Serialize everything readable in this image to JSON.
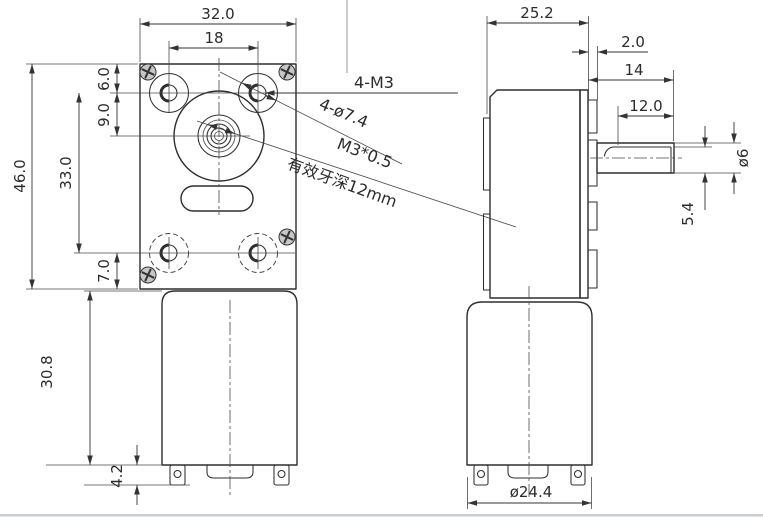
{
  "front": {
    "width": "32.0",
    "hole_span": "18",
    "height": "46.0",
    "edge_to_hole": "6.0",
    "hole_to_shaft": "9.0",
    "hole_span_v": "33.0",
    "hole_to_bottom": "7.0",
    "motor_length": "30.8",
    "terminal_depth": "4.2",
    "screws_label": "4-M3",
    "holes_label": "4-ø7.4",
    "thread_label": "M3*0.5",
    "thread_depth_label": "有效牙深12mm"
  },
  "side": {
    "depth": "25.2",
    "boss_offset": "2.0",
    "shaft_length": "14",
    "flat_length": "12.0",
    "shaft_dia": "ø6",
    "flat_height": "5.4",
    "motor_dia": "ø24.4"
  }
}
